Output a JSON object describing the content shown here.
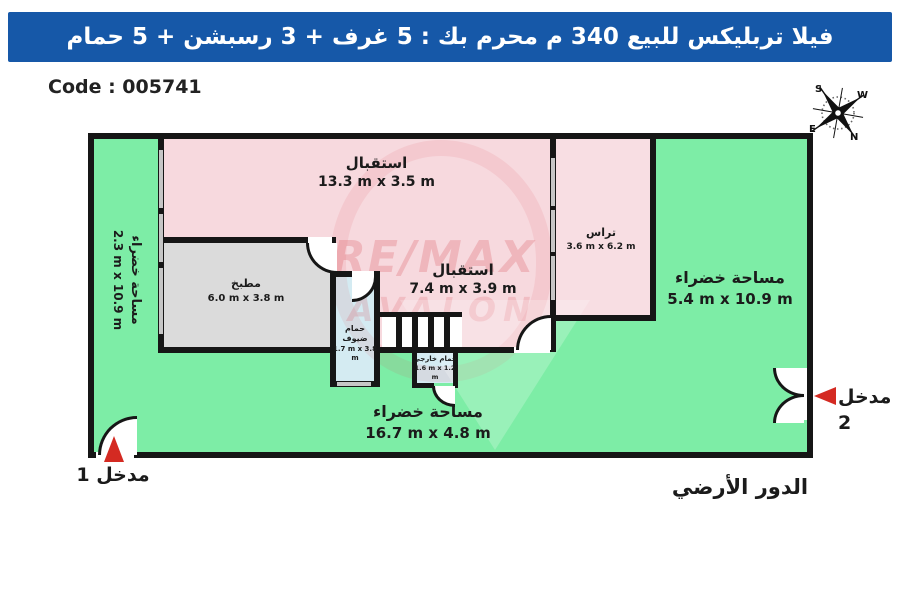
{
  "header": {
    "title": "فيلا تربليكس للبيع 340 م محرم بك :  5 غرف + 3 رسبشن + 5 حمام",
    "bg_color": "#1658a8"
  },
  "code_label": "Code : 005741",
  "floor_label": "الدور الأرضي",
  "entrances": {
    "entrance1": "مدخل 1",
    "entrance2": "مدخل 2"
  },
  "rooms": {
    "reception1": {
      "name": "استقبال",
      "dims": "13.3 m x 3.5 m"
    },
    "reception2": {
      "name": "استقبال",
      "dims": "7.4 m x 3.9 m"
    },
    "kitchen": {
      "name": "مطبخ",
      "dims": "6.0 m x 3.8 m"
    },
    "guest_bath": {
      "name": "حمام ضيوف",
      "dims": "1.7 m x 3.8 m"
    },
    "outdoor_bath": {
      "name": "حمام خارجي",
      "dims": "1.6 m x 1.2 m"
    },
    "terrace": {
      "name": "تراس",
      "dims": "3.6 m x 6.2 m"
    },
    "green_left": {
      "name": "مساحة خضراء",
      "dims": "2.3 m x 10.9 m"
    },
    "green_right": {
      "name": "مساحة خضراء",
      "dims": "5.4 m x 10.9 m"
    },
    "green_bottom": {
      "name": "مساحة خضراء",
      "dims": "16.7 m x 4.8 m"
    }
  },
  "compass": {
    "n": "N",
    "s": "S",
    "e": "E",
    "w": "W"
  },
  "watermark": {
    "line1": "RE/MAX",
    "line2": "AVALON"
  },
  "colors": {
    "green_area": "#7deda6",
    "room_pink": "#f7d9de",
    "kitchen_gray": "#dbdbdb",
    "bath_blue": "#d4ebf2",
    "wall_black": "#161616",
    "window_gray": "#c6c6c6",
    "arrow_red": "#d42a22",
    "header_blue": "#1658a8"
  }
}
